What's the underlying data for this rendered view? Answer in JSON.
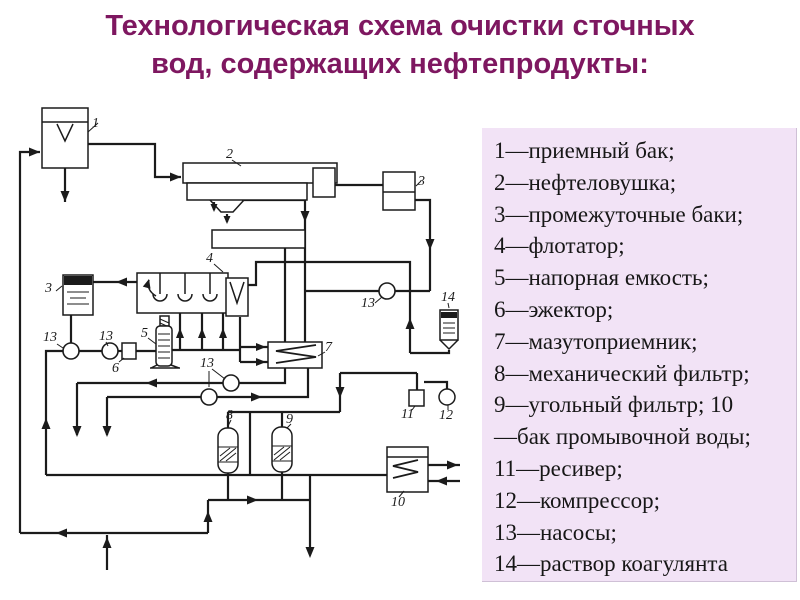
{
  "title": {
    "line1": "Технологическая схема очистки сточных",
    "line2": "вод, содержащих нефтепродукты:",
    "color": "#7e1760"
  },
  "legend": {
    "background": "#f2e3f6",
    "lines": [
      "1—приемный бак;",
      "2—нефтеловушка;",
      "3—промежуточные баки;",
      "4—флотатор;",
      "5—напорная емкость;",
      "6—эжектор;",
      "7—мазутоприемник;",
      "8—механический фильтр;",
      "9—угольный фильтр; 10",
      "—бак промывочной воды;",
      "11—ресивер;",
      "12—компрессор;",
      "13—насосы;",
      "14—раствор коагулянта"
    ]
  },
  "diagram": {
    "stroke": "#1b1b1b",
    "labels": [
      {
        "t": "1",
        "x": 92,
        "y": 127
      },
      {
        "t": "2",
        "x": 226,
        "y": 158
      },
      {
        "t": "3",
        "x": 45,
        "y": 292
      },
      {
        "t": "3",
        "x": 418,
        "y": 185
      },
      {
        "t": "4",
        "x": 206,
        "y": 262
      },
      {
        "t": "5",
        "x": 141,
        "y": 337
      },
      {
        "t": "6",
        "x": 112,
        "y": 372
      },
      {
        "t": "7",
        "x": 325,
        "y": 351
      },
      {
        "t": "8",
        "x": 226,
        "y": 419
      },
      {
        "t": "9",
        "x": 286,
        "y": 423
      },
      {
        "t": "10",
        "x": 391,
        "y": 506
      },
      {
        "t": "11",
        "x": 401,
        "y": 418
      },
      {
        "t": "12",
        "x": 439,
        "y": 419
      },
      {
        "t": "13",
        "x": 43,
        "y": 341
      },
      {
        "t": "13",
        "x": 99,
        "y": 340
      },
      {
        "t": "13",
        "x": 200,
        "y": 367
      },
      {
        "t": "13",
        "x": 361,
        "y": 307
      },
      {
        "t": "14",
        "x": 441,
        "y": 301
      }
    ]
  }
}
